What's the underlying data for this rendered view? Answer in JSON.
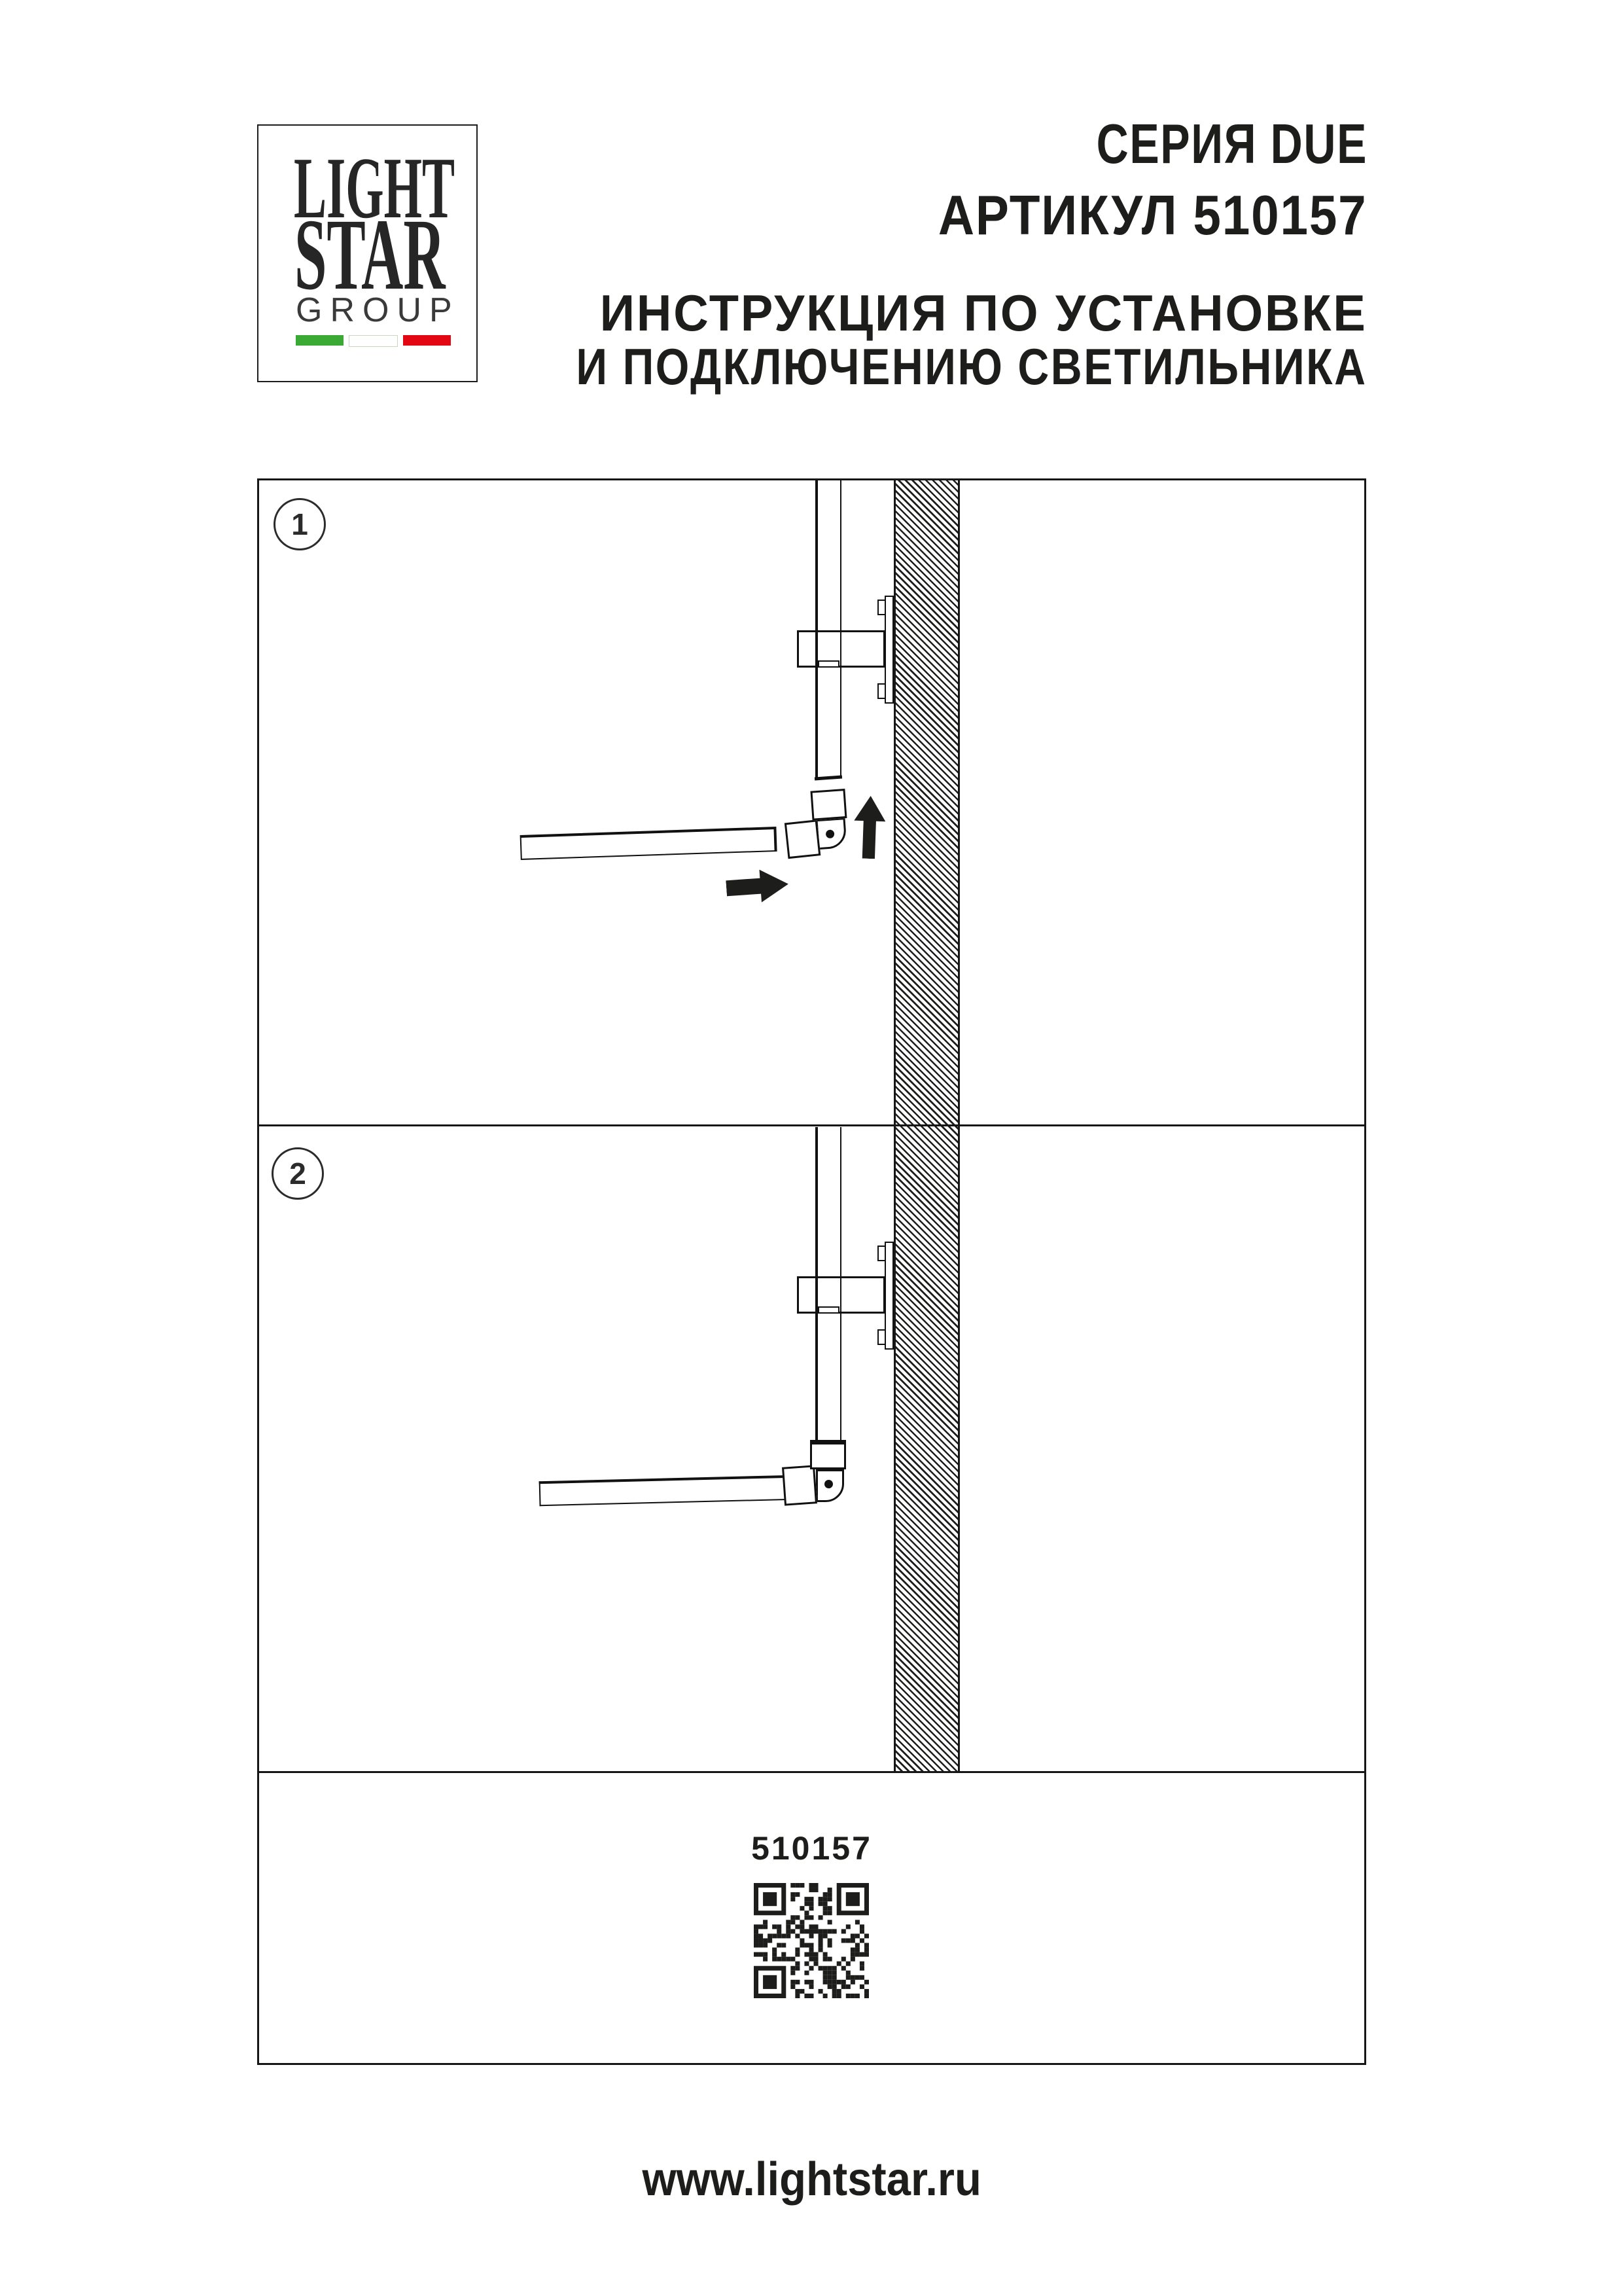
{
  "page": {
    "ink": "#1d1d1b"
  },
  "logo": {
    "line1": "LIGHT",
    "line2": "STAR",
    "line3": "GROUP",
    "flag_green": "#3aaa35",
    "flag_white": "#ffffff",
    "flag_red": "#e30613"
  },
  "header": {
    "series": "СЕРИЯ DUE",
    "article": "АРТИКУЛ 510157",
    "instruction_line1": "ИНСТРУКЦИЯ ПО УСТАНОВКЕ",
    "instruction_line2": "И ПОДКЛЮЧЕНИЮ СВЕТИЛЬНИКА"
  },
  "steps": [
    {
      "number": "1"
    },
    {
      "number": "2"
    }
  ],
  "article_section": {
    "code": "510157"
  },
  "footer": {
    "url": "www.lightstar.ru"
  }
}
